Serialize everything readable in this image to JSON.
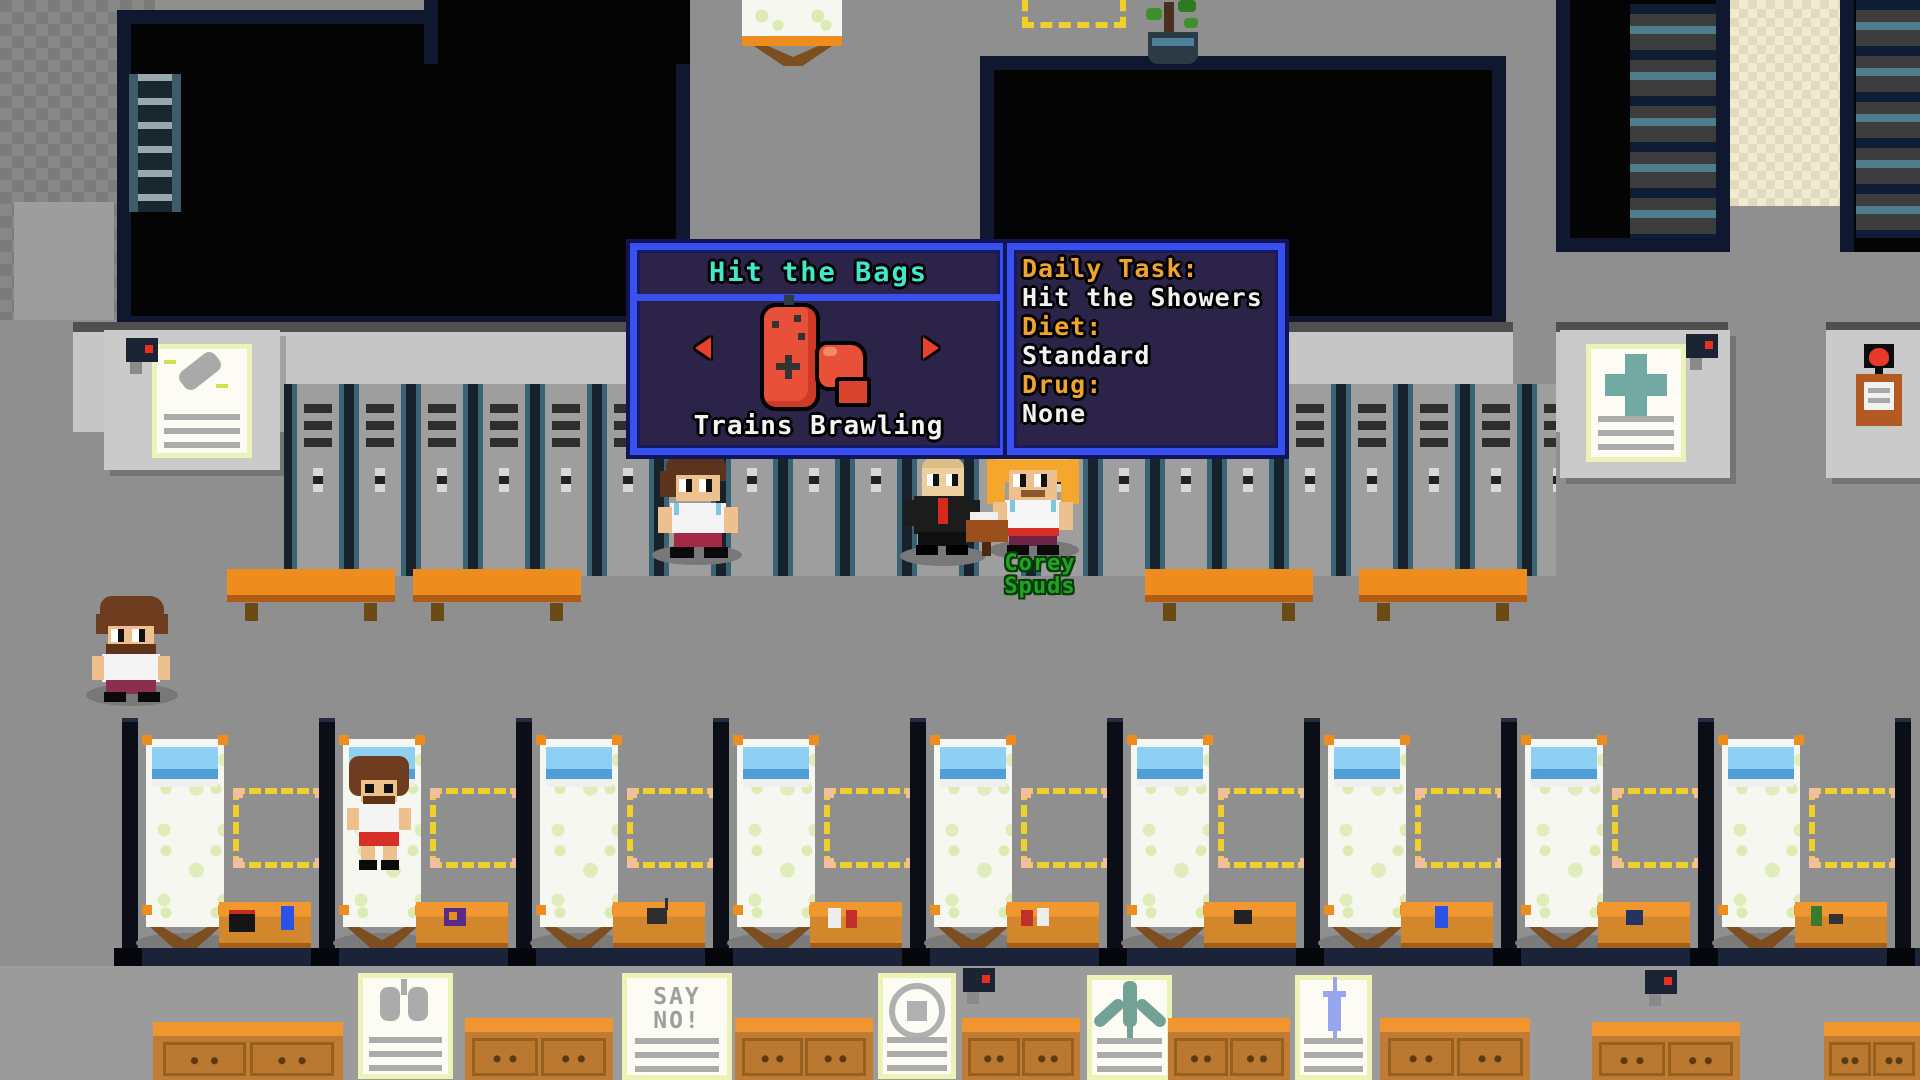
{
  "hud": {
    "training_panel": {
      "title": "Hit the Bags",
      "subtitle": "Trains Brawling",
      "prev_icon": "arrow-left-icon",
      "next_icon": "arrow-right-icon",
      "equipment_icon": "punching-bag-icon",
      "glove_icon": "boxing-glove-icon"
    },
    "status_panel": {
      "rows": [
        {
          "label": "Daily Task:",
          "value": "Hit the Showers"
        },
        {
          "label": "Diet:",
          "value": "Standard"
        },
        {
          "label": "Drug:",
          "value": "None"
        }
      ]
    },
    "npc_label": "Corey Spuds"
  },
  "posters": {
    "say_no_text": "SAY NO!"
  },
  "colors": {
    "panel_border_blue": "#3850f0",
    "panel_outline_navy": "#12145a",
    "panel_bg_purple": "#2b2348",
    "title_teal": "#3fe9c9",
    "label_orange": "#f2a32c",
    "value_white": "#f2f2f2",
    "npc_name_green": "#23a326",
    "slot_dash_yellow": "#f0d02a",
    "bench_orange": "#ef8c1e",
    "locker_teal": "#3a6474",
    "floor_gray": "#8f8f8f",
    "room_border_navy": "#101830",
    "pillow_blue": "#7ec8f0",
    "bag_red": "#e8503a"
  }
}
